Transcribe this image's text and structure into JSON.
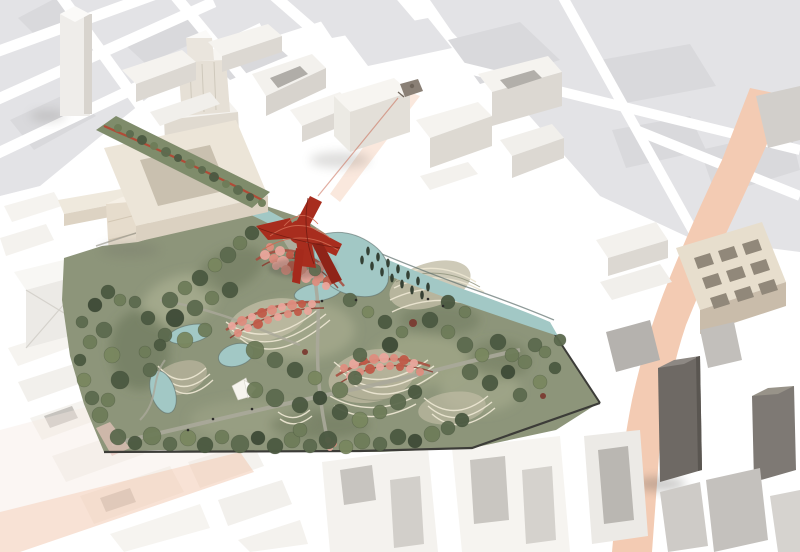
{
  "meta": {
    "description": "Aerial architectural rendering of an urban masterplan: a large terraced public park with ponds, pink blossom pavilions and a red lattice tower sits inside a white 3D city model, bordered by a teal canal, a rooftop greenway and a salmon-coloured avenue; flat light-grey map parcels fade out at the edges."
  },
  "palette": {
    "background": "#ffffff",
    "flat_parcel": "#e3e3e6",
    "flat_parcel_dark": "#d9d9dc",
    "building_white": "#f5f3ef",
    "building_facade": "#dcd8d2",
    "building_shade": "#c5c1bb",
    "building_tan": "#e7decd",
    "building_dark": "#6e6964",
    "building_dark2": "#7e7974",
    "park_green": "#8d957a",
    "park_light": "#a8ad8f",
    "park_dark": "#5e6b4f",
    "greenway_green": "#7f8c6b",
    "tree_colors": [
      "#5c6a4e",
      "#4b5941",
      "#6e7c59",
      "#79875f",
      "#3e4b37"
    ],
    "poplar": "#2e3a2d",
    "water": "#a2c8c5",
    "water_edge": "#5f706d",
    "terrace_light": "#ece6d2",
    "terrace_base": "#c2bda6",
    "blossom_pink": "#e9a79c",
    "blossom_mid": "#dd8d7e",
    "blossom_deep": "#c05a48",
    "structure_red": "#a82d1e",
    "structure_red_light": "#d06a52",
    "road_salmon": "#f3cbb3",
    "road_salmon_light": "#f7e4d8",
    "path_light": "#aaa89a",
    "path_dark": "#64665c",
    "boundary_dark": "#3c3c38",
    "accent_tree": "#7a3b32",
    "figure": "#2c2c2a"
  },
  "scene": {
    "trees": [
      [
        118,
        437,
        8,
        0
      ],
      [
        135,
        443,
        7,
        1
      ],
      [
        152,
        436,
        9,
        2
      ],
      [
        170,
        444,
        7,
        0
      ],
      [
        188,
        438,
        8,
        3
      ],
      [
        205,
        445,
        8,
        1
      ],
      [
        222,
        437,
        7,
        2
      ],
      [
        240,
        444,
        9,
        0
      ],
      [
        258,
        438,
        7,
        4
      ],
      [
        275,
        446,
        8,
        1
      ],
      [
        292,
        440,
        8,
        2
      ],
      [
        310,
        446,
        7,
        0
      ],
      [
        328,
        440,
        9,
        1
      ],
      [
        346,
        447,
        7,
        3
      ],
      [
        362,
        441,
        8,
        2
      ],
      [
        380,
        444,
        7,
        0
      ],
      [
        398,
        437,
        8,
        1
      ],
      [
        415,
        441,
        7,
        4
      ],
      [
        432,
        434,
        8,
        2
      ],
      [
        448,
        428,
        7,
        0
      ],
      [
        462,
        420,
        7,
        1
      ],
      [
        100,
        415,
        8,
        2
      ],
      [
        92,
        398,
        7,
        0
      ],
      [
        84,
        380,
        7,
        3
      ],
      [
        80,
        360,
        6,
        1
      ],
      [
        90,
        342,
        7,
        2
      ],
      [
        82,
        322,
        6,
        0
      ],
      [
        95,
        305,
        7,
        4
      ],
      [
        108,
        292,
        7,
        1
      ],
      [
        120,
        300,
        6,
        2
      ],
      [
        104,
        330,
        8,
        0
      ],
      [
        112,
        355,
        8,
        3
      ],
      [
        120,
        380,
        9,
        1
      ],
      [
        108,
        400,
        7,
        2
      ],
      [
        170,
        300,
        8,
        0
      ],
      [
        185,
        288,
        7,
        2
      ],
      [
        200,
        278,
        8,
        1
      ],
      [
        215,
        265,
        7,
        3
      ],
      [
        228,
        255,
        8,
        0
      ],
      [
        240,
        243,
        7,
        2
      ],
      [
        252,
        233,
        7,
        1
      ],
      [
        175,
        318,
        9,
        4
      ],
      [
        195,
        308,
        8,
        0
      ],
      [
        212,
        298,
        7,
        2
      ],
      [
        230,
        290,
        8,
        1
      ],
      [
        165,
        335,
        7,
        0
      ],
      [
        185,
        340,
        8,
        3
      ],
      [
        205,
        330,
        7,
        2
      ],
      [
        148,
        318,
        7,
        1
      ],
      [
        135,
        302,
        6,
        0
      ],
      [
        255,
        350,
        9,
        2
      ],
      [
        275,
        360,
        8,
        0
      ],
      [
        295,
        370,
        8,
        1
      ],
      [
        315,
        378,
        7,
        3
      ],
      [
        255,
        390,
        8,
        2
      ],
      [
        275,
        398,
        9,
        0
      ],
      [
        300,
        405,
        8,
        1
      ],
      [
        320,
        398,
        7,
        4
      ],
      [
        340,
        390,
        8,
        2
      ],
      [
        355,
        378,
        7,
        0
      ],
      [
        340,
        412,
        8,
        1
      ],
      [
        360,
        420,
        8,
        3
      ],
      [
        380,
        412,
        7,
        2
      ],
      [
        398,
        402,
        8,
        0
      ],
      [
        415,
        392,
        7,
        1
      ],
      [
        300,
        430,
        7,
        2
      ],
      [
        360,
        355,
        7,
        0
      ],
      [
        390,
        345,
        8,
        4
      ],
      [
        430,
        320,
        8,
        1
      ],
      [
        448,
        332,
        7,
        2
      ],
      [
        465,
        345,
        8,
        0
      ],
      [
        482,
        355,
        7,
        3
      ],
      [
        498,
        342,
        8,
        1
      ],
      [
        512,
        355,
        7,
        2
      ],
      [
        470,
        372,
        8,
        0
      ],
      [
        490,
        383,
        8,
        1
      ],
      [
        508,
        372,
        7,
        4
      ],
      [
        525,
        362,
        7,
        2
      ],
      [
        535,
        345,
        7,
        0
      ],
      [
        448,
        302,
        7,
        1
      ],
      [
        465,
        312,
        6,
        2
      ],
      [
        520,
        395,
        7,
        0
      ],
      [
        540,
        382,
        7,
        3
      ],
      [
        555,
        368,
        6,
        1
      ],
      [
        545,
        352,
        6,
        2
      ],
      [
        560,
        340,
        6,
        0
      ],
      [
        300,
        255,
        6,
        1
      ],
      [
        315,
        270,
        6,
        2
      ],
      [
        350,
        300,
        7,
        0
      ],
      [
        368,
        312,
        6,
        3
      ],
      [
        385,
        322,
        7,
        1
      ],
      [
        402,
        332,
        6,
        2
      ],
      [
        150,
        370,
        7,
        0
      ],
      [
        145,
        352,
        6,
        2
      ],
      [
        160,
        345,
        6,
        1
      ]
    ],
    "greenway_trees": [
      [
        118,
        128,
        4,
        2
      ],
      [
        130,
        134,
        4,
        0
      ],
      [
        142,
        140,
        5,
        1
      ],
      [
        154,
        146,
        4,
        2
      ],
      [
        166,
        152,
        5,
        0
      ],
      [
        178,
        158,
        4,
        1
      ],
      [
        190,
        164,
        5,
        2
      ],
      [
        202,
        170,
        4,
        0
      ],
      [
        214,
        177,
        5,
        1
      ],
      [
        226,
        184,
        4,
        2
      ],
      [
        238,
        190,
        5,
        0
      ],
      [
        250,
        197,
        4,
        1
      ],
      [
        262,
        203,
        4,
        2
      ]
    ],
    "poplars": [
      [
        362,
        260
      ],
      [
        372,
        266
      ],
      [
        382,
        272
      ],
      [
        392,
        278
      ],
      [
        402,
        284
      ],
      [
        412,
        290
      ],
      [
        422,
        295
      ],
      [
        368,
        251
      ],
      [
        378,
        257
      ],
      [
        388,
        263
      ],
      [
        398,
        269
      ],
      [
        408,
        275
      ],
      [
        418,
        281
      ],
      [
        428,
        287
      ]
    ],
    "blossoms": {
      "cluster_a": [
        [
          265,
          255,
          5,
          0
        ],
        [
          274,
          259,
          5,
          1
        ],
        [
          283,
          262,
          6,
          0
        ],
        [
          292,
          266,
          5,
          2
        ],
        [
          301,
          270,
          6,
          1
        ],
        [
          310,
          274,
          5,
          0
        ],
        [
          319,
          277,
          5,
          1
        ],
        [
          328,
          281,
          5,
          2
        ],
        [
          270,
          247,
          4,
          1
        ],
        [
          280,
          251,
          5,
          0
        ],
        [
          290,
          255,
          4,
          2
        ],
        [
          300,
          259,
          5,
          1
        ],
        [
          310,
          263,
          4,
          0
        ],
        [
          320,
          267,
          5,
          1
        ],
        [
          330,
          271,
          4,
          2
        ],
        [
          276,
          266,
          4,
          0
        ],
        [
          286,
          270,
          5,
          1
        ],
        [
          296,
          274,
          4,
          2
        ],
        [
          306,
          278,
          5,
          0
        ],
        [
          316,
          282,
          4,
          1
        ],
        [
          326,
          286,
          4,
          0
        ]
      ],
      "cluster_b": [
        [
          232,
          326,
          4,
          0
        ],
        [
          242,
          321,
          5,
          1
        ],
        [
          252,
          317,
          4,
          0
        ],
        [
          262,
          313,
          5,
          2
        ],
        [
          272,
          310,
          5,
          1
        ],
        [
          282,
          307,
          4,
          0
        ],
        [
          292,
          305,
          5,
          1
        ],
        [
          302,
          304,
          4,
          2
        ],
        [
          312,
          304,
          4,
          0
        ],
        [
          238,
          333,
          4,
          1
        ],
        [
          248,
          328,
          4,
          0
        ],
        [
          258,
          324,
          5,
          2
        ],
        [
          268,
          320,
          4,
          1
        ],
        [
          278,
          317,
          4,
          0
        ],
        [
          288,
          314,
          4,
          1
        ],
        [
          298,
          312,
          4,
          2
        ],
        [
          308,
          311,
          4,
          0
        ]
      ],
      "cluster_c": [
        [
          344,
          368,
          4,
          1
        ],
        [
          354,
          364,
          5,
          0
        ],
        [
          364,
          361,
          4,
          2
        ],
        [
          374,
          359,
          5,
          1
        ],
        [
          384,
          358,
          5,
          0
        ],
        [
          394,
          358,
          4,
          1
        ],
        [
          404,
          360,
          5,
          2
        ],
        [
          414,
          363,
          4,
          0
        ],
        [
          350,
          376,
          4,
          0
        ],
        [
          360,
          372,
          4,
          1
        ],
        [
          370,
          369,
          5,
          2
        ],
        [
          380,
          367,
          4,
          0
        ],
        [
          390,
          366,
          4,
          1
        ],
        [
          400,
          367,
          4,
          2
        ],
        [
          410,
          369,
          4,
          0
        ],
        [
          420,
          372,
          4,
          1
        ]
      ],
      "south_blob": [
        [
          328,
          440,
          3,
          0
        ],
        [
          334,
          444,
          3,
          1
        ],
        [
          330,
          448,
          3,
          0
        ]
      ]
    },
    "accent_trees": [
      [
        413,
        323,
        4
      ],
      [
        543,
        396,
        3
      ],
      [
        305,
        352,
        3
      ]
    ],
    "figures": [
      [
        428,
        299
      ],
      [
        443,
        306
      ],
      [
        213,
        419
      ],
      [
        252,
        409
      ],
      [
        322,
        301
      ],
      [
        188,
        430
      ],
      [
        356,
        300
      ]
    ]
  }
}
